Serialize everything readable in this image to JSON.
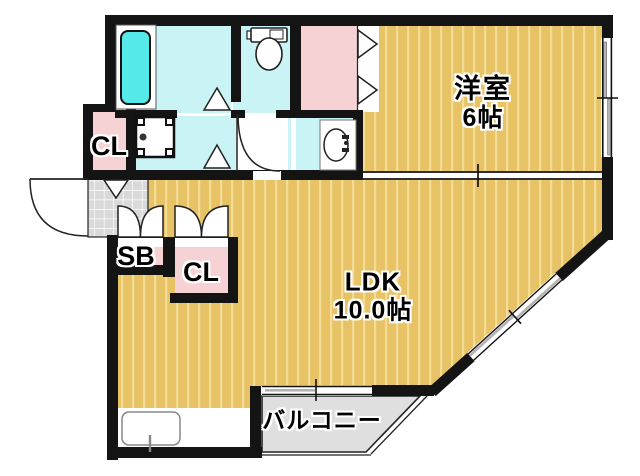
{
  "floorplan": {
    "labels": {
      "western_room_name": "洋室",
      "western_room_size": "6帖",
      "ldk_name": "LDK",
      "ldk_size": "10.0帖",
      "balcony": "バルコニー",
      "closet_upper": "CL",
      "closet_lower": "CL",
      "shoe_box": "SB"
    },
    "colors": {
      "wall": "#141414",
      "wood_floor": "#e8c365",
      "wood_stripe": "#f2dc96",
      "water_room": "#c9f3f5",
      "bathtub": "#55e9ea",
      "closet_pink": "#f7d2d5",
      "entrance_tile": "#d9d9d9",
      "balcony_gray": "#dfdfdf"
    }
  }
}
